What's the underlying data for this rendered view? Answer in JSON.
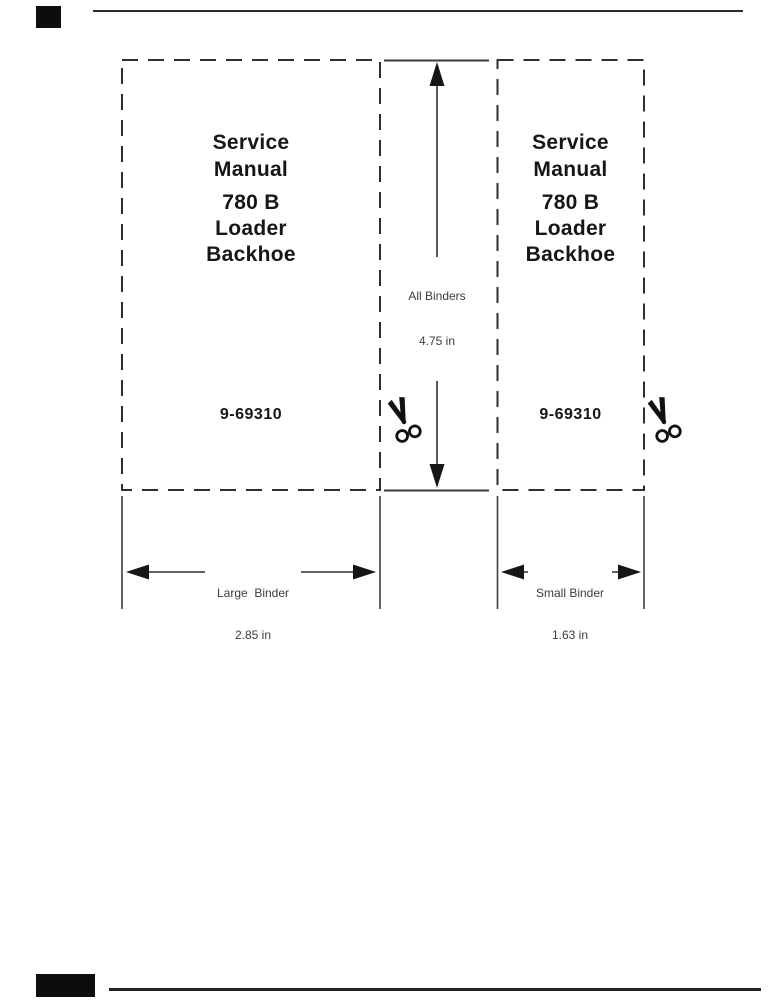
{
  "page": {
    "background": "#ffffff",
    "ink": "#161616",
    "dimension_line_color": "#555555",
    "dash_color": "#2e2e2e"
  },
  "binders": [
    {
      "name": "large",
      "title": [
        "Service",
        "Manual"
      ],
      "model": [
        "780 B",
        "Loader",
        "Backhoe"
      ],
      "part_number": "9-69310"
    },
    {
      "name": "small",
      "title": [
        "Service",
        "Manual"
      ],
      "model": [
        "780 B",
        "Loader",
        "Backhoe"
      ],
      "part_number": "9-69310"
    }
  ],
  "dimensions": {
    "all_binders": {
      "label": "All Binders",
      "value": "4.75 in"
    },
    "large_binder": {
      "label": "Large  Binder",
      "value": "2.85 in"
    },
    "small_binder": {
      "label": "Small Binder",
      "value": "1.63 in"
    }
  },
  "icons": {
    "scissors": "cut-here"
  }
}
